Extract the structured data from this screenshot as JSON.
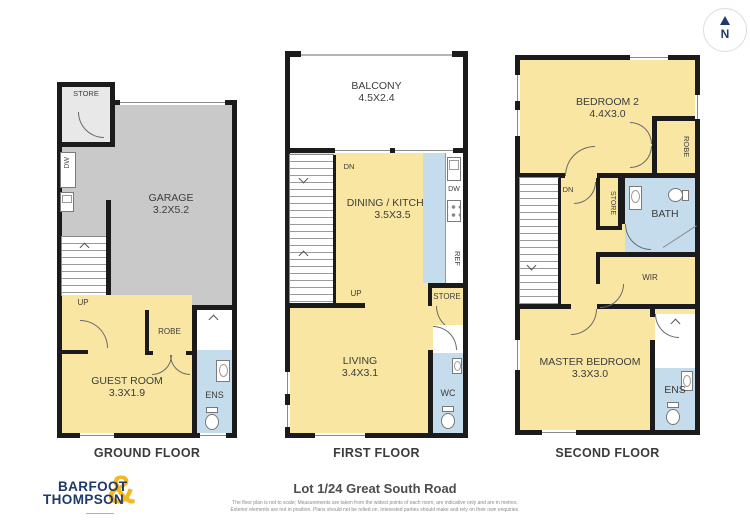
{
  "compass": {
    "north": "N"
  },
  "ground": {
    "caption": "GROUND FLOOR",
    "store": "STORE",
    "dw": "DW",
    "garage": "GARAGE",
    "garage_dims": "3.2X5.2",
    "up": "UP",
    "robe": "ROBE",
    "guest": "GUEST ROOM",
    "guest_dims": "3.3X1.9",
    "ens": "ENS"
  },
  "first": {
    "caption": "FIRST FLOOR",
    "balcony": "BALCONY",
    "balcony_dims": "4.5X2.4",
    "dn": "DN",
    "dining": "DINING / KITCHEN",
    "dining_dims": "3.5X3.5",
    "dw": "DW",
    "ref": "REF",
    "up": "UP",
    "store": "STORE",
    "living": "LIVING",
    "living_dims": "3.4X3.1",
    "wc": "WC"
  },
  "second": {
    "caption": "SECOND FLOOR",
    "bedroom2": "BEDROOM 2",
    "bedroom2_dims": "4.4X3.0",
    "robe": "ROBE",
    "dn": "DN",
    "store": "STORE",
    "bath": "BATH",
    "wir": "WIR",
    "master": "MASTER BEDROOM",
    "master_dims": "3.3X3.0",
    "ens": "ENS"
  },
  "footer": {
    "brand_line1": "BARFOOT",
    "brand_line2": "THOMPSON",
    "brand_amp": "&",
    "title": "Lot 1/24 Great South Road",
    "disclaimer1": "The floor plan is not to scale; Measurements are taken from the widest points of each room, are indicative only and are in metres.",
    "disclaimer2": "Exterior elements are not in position. Plans should not be relied on. Interested parties should make and rely on their own enquiries."
  },
  "colors": {
    "wall": "#1b1b1b",
    "room_yellow": "#f8e6a2",
    "wet_area_blue": "#c5dcec",
    "garage_grey": "#c9c9c9",
    "brand_navy": "#1e3a6b",
    "brand_gold": "#f3b71f"
  }
}
